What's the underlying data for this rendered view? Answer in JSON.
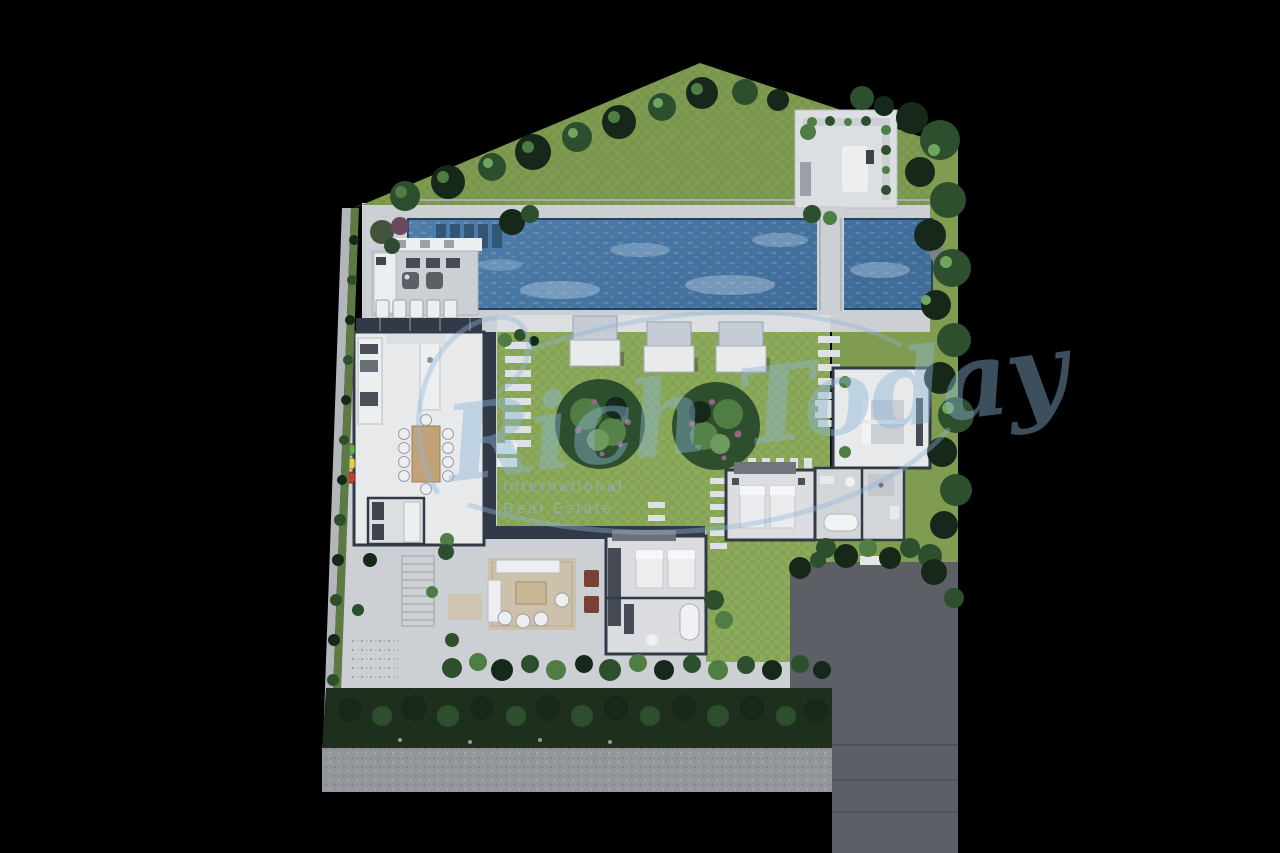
{
  "watermark": {
    "script_text": "Rich Today",
    "tagline_line1": "International",
    "tagline_line2": "Real Estate"
  },
  "colors": {
    "background": "#000000",
    "grass": "#7f9c50",
    "grass_bright": "#8cab5b",
    "grass_dark": "#5d7a42",
    "tree_dark": "#16281a",
    "tree_mid": "#2d4f2e",
    "tree_light": "#4f7d44",
    "tree_highlight": "#6fa55e",
    "bloom": "#93688a",
    "water": "#4c7aa6",
    "water_deep": "#3f6c99",
    "water_light": "#cfe2ef",
    "deck": "#ccd0d4",
    "deck_light": "#dcdfe2",
    "floor_white": "#e7e9eb",
    "wall_dark": "#333a47",
    "roof_gray": "#9aa0a8",
    "driveway": "#5c5f66",
    "road": "#93969a",
    "hedge": "#1e301d",
    "rug": "#cec0a9",
    "wood": "#c2a379",
    "pot_red": "#7a4034",
    "bin_green": "#5fae4b",
    "bin_yellow": "#d9d44c",
    "bin_red": "#bf4037",
    "watermark": "#8db4d5"
  },
  "features": {
    "site": "villa top-view site plan",
    "pool": "long lap pool with plunge pool and bridge",
    "spa_court": "roof lounge court",
    "pool_bar": "pool bar cabana",
    "daybeds": "three canopy daybeds",
    "lawn": "central lawn with flowering trees",
    "bedrooms": "bedroom pavilions with beds and baths",
    "living": "open lounge terrace",
    "kitchen": "kitchen and dining wing",
    "driveway": "dark driveway and access road",
    "hedges": "perimeter hedges and tree rows"
  }
}
